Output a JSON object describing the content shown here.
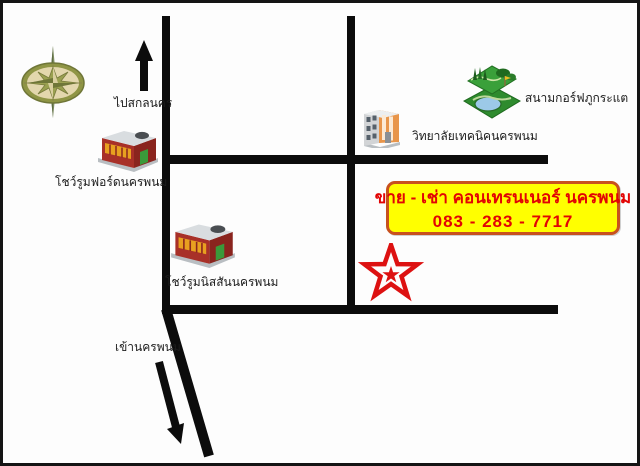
{
  "map": {
    "labels": {
      "to_sakon_nakhon": "ไปสกลนคร",
      "ford_showroom": "โชว์รูมฟอร์ดนครพนม",
      "nissan_showroom": "โชว์รูมนิสสันนครพนม",
      "technical_college": "วิทยาลัยเทคนิคนครพนม",
      "golf_course": "สนามกอร์ฟภูกระแต",
      "city_entrance": "เข้านครพนม"
    },
    "ad_box": {
      "line1": "ขาย - เช่า คอนเทรนเนอร์ นครพนม",
      "line2": "083 - 283 - 7717"
    },
    "icons": [
      "compass-rose-icon",
      "north-arrow-icon",
      "ford-showroom-building-icon",
      "nissan-showroom-building-icon",
      "technical-college-building-icon",
      "golf-course-icon",
      "location-star-icon",
      "city-entry-arrow-icon"
    ],
    "colors": {
      "road": "#0c0c0c",
      "ad_background": "#ffff00",
      "ad_border": "#c8511e",
      "ad_text": "#e20404",
      "star": "#dd1111",
      "compass_rim": "#8f9545",
      "compass_face": "#e3d7ad"
    }
  }
}
